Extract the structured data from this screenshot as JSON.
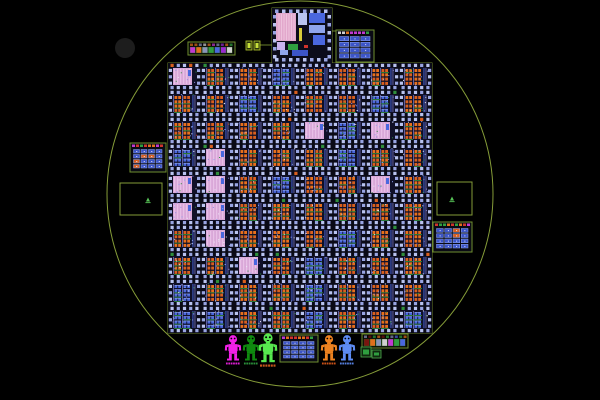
{
  "app": {
    "background": "#000000",
    "seed": 7
  },
  "wafer": {
    "cx": 300,
    "cy": 194,
    "r": 193,
    "outline_color": "#93ad3e"
  },
  "mark_circle": {
    "cx": 125,
    "cy": 48,
    "r": 10,
    "color": "#1d1d1d"
  },
  "outlines": {
    "color": "#7d9636",
    "grid": {
      "x": 168,
      "y": 63,
      "w": 264,
      "h": 270
    },
    "top_die": {
      "x": 272,
      "y": 8,
      "w": 60,
      "h": 55
    },
    "connectors": [
      {
        "x1": 259,
        "y1": 45,
        "x2": 272,
        "y2": 45
      },
      {
        "x1": 332,
        "y1": 31,
        "x2": 336,
        "y2": 31
      }
    ]
  },
  "die_grid": {
    "x": 168,
    "y": 63,
    "cols": 8,
    "rows": 10,
    "cell_w": 33,
    "cell_h": 27,
    "colors": {
      "bg": "#0a0a16",
      "inner": "#101028",
      "pad": "#b9c3ef",
      "pad_dim": "#98a4e2",
      "orange": "#d95f1e",
      "orange2": "#e8701c",
      "blue": "#4a67de",
      "blue_light": "#8fa5ec",
      "violet": "#8d8de0",
      "green_line": "#2f8f3c",
      "pink": "#d9a8d8",
      "pink_light": "#eac4ea",
      "white": "#e8e8f4",
      "red": "#d0342c"
    },
    "variant_pink_prob": 0.08,
    "variant_blue_prob": 0.18
  },
  "top_die": {
    "x": 272,
    "y": 8,
    "w": 60,
    "h": 55,
    "bg": "#0c0c1a",
    "features": [
      {
        "x": 276,
        "y": 13,
        "w": 20,
        "h": 28,
        "fill": "#e2a8cc",
        "striped": true
      },
      {
        "x": 277,
        "y": 42,
        "w": 8,
        "h": 8,
        "fill": "#c9b2ee"
      },
      {
        "x": 298,
        "y": 13,
        "w": 9,
        "h": 12,
        "fill": "#b9c3ef"
      },
      {
        "x": 309,
        "y": 13,
        "w": 16,
        "h": 10,
        "fill": "#4a67de"
      },
      {
        "x": 309,
        "y": 25,
        "w": 16,
        "h": 8,
        "fill": "#8fa5ec"
      },
      {
        "x": 313,
        "y": 35,
        "w": 12,
        "h": 10,
        "fill": "#4a67de"
      },
      {
        "x": 299,
        "y": 28,
        "w": 3,
        "h": 13,
        "fill": "#d8cc3a"
      },
      {
        "x": 288,
        "y": 44,
        "w": 10,
        "h": 6,
        "fill": "#2f9f3f"
      },
      {
        "x": 304,
        "y": 45,
        "w": 4,
        "h": 3,
        "fill": "#d0342c"
      },
      {
        "x": 292,
        "y": 50,
        "w": 16,
        "h": 6,
        "fill": "#3c55c8"
      },
      {
        "x": 280,
        "y": 50,
        "w": 8,
        "h": 5,
        "fill": "#8fa5ec"
      }
    ]
  },
  "mini_dies": [
    {
      "name": "left-edge-die",
      "x": 130,
      "y": 143,
      "w": 36,
      "h": 29,
      "cols": 4,
      "rows": 4,
      "orange_prob": 0.2
    },
    {
      "name": "top-right-die",
      "x": 336,
      "y": 30,
      "w": 38,
      "h": 32,
      "cols": 3,
      "rows": 4,
      "orange_prob": 0.12
    },
    {
      "name": "right-edge-die",
      "x": 433,
      "y": 222,
      "w": 39,
      "h": 30,
      "cols": 4,
      "rows": 4,
      "orange_prob": 0.2
    },
    {
      "name": "bottom-center-die",
      "x": 280,
      "y": 335,
      "w": 38,
      "h": 27,
      "cols": 4,
      "rows": 4,
      "orange_prob": 0.05
    }
  ],
  "mini_die_colors": {
    "border": "#6f8f2f",
    "bg": "#0a0a14",
    "cell": "#3c55c8",
    "cell_edge": "#8fa5ec",
    "dot": "#e8e8f4",
    "orange": "#d95f1e",
    "header": [
      "#2f9f3f",
      "#c03ad0",
      "#d0d0d0",
      "#d0342c",
      "#e0701c"
    ]
  },
  "legend_strips": [
    {
      "name": "top-left-legend",
      "x": 188,
      "y": 42,
      "w": 47,
      "h": 13,
      "cells": [
        "#c03ad0",
        "#e0701c",
        "#8a94b8",
        "#2f9f3f",
        "#4a67de",
        "#9a2ad0",
        "#d0d0d0"
      ]
    },
    {
      "name": "bottom-right-legend",
      "x": 362,
      "y": 334,
      "w": 46,
      "h": 14,
      "cells": [
        "#7a1410",
        "#e0701c",
        "#8a94b8",
        "#d0d0d0",
        "#c03ad0",
        "#2f9f3f",
        "#4a67de"
      ]
    }
  ],
  "green_pads_top": [
    {
      "x": 246,
      "y": 41,
      "w": 6,
      "h": 9
    },
    {
      "x": 254,
      "y": 41,
      "w": 6,
      "h": 9
    }
  ],
  "green_squares_bottom": [
    {
      "x": 361,
      "y": 347,
      "w": 10,
      "h": 10
    },
    {
      "x": 372,
      "y": 350,
      "w": 9,
      "h": 8
    }
  ],
  "green_pad_colors": {
    "fill": "#2a330c",
    "stroke": "#b9cf2e",
    "inner": "#c8e03a"
  },
  "green_square_colors": {
    "fill": "#0f2a0f",
    "stroke": "#4fae4f",
    "inner": "#2f9f3f"
  },
  "alignment_squares": [
    {
      "name": "left-alignment-square",
      "x": 120,
      "y": 183,
      "w": 42,
      "h": 32,
      "gx": 148,
      "gy": 200
    },
    {
      "name": "right-alignment-square",
      "x": 437,
      "y": 182,
      "w": 35,
      "h": 33,
      "gx": 452,
      "gy": 199
    }
  ],
  "alignment_color": "#93ad3e",
  "glyph_color": "#58c558",
  "robots": [
    {
      "name": "magenta",
      "color": "#f320e8",
      "label_color": "#f320e8",
      "x": 233,
      "y": 348,
      "scale": 0.88
    },
    {
      "name": "dark-green",
      "color": "#0f8a0f",
      "label_color": "#2f9f3f",
      "x": 251,
      "y": 348,
      "scale": 0.88
    },
    {
      "name": "lime",
      "color": "#57e84f",
      "label_color": "#d95f1e",
      "x": 268,
      "y": 348,
      "scale": 1.0
    },
    {
      "name": "orange",
      "color": "#ef8320",
      "label_color": "#e05a1a",
      "x": 329,
      "y": 348,
      "scale": 0.88
    },
    {
      "name": "blue",
      "color": "#5e8cf5",
      "label_color": "#5e8cf5",
      "x": 347,
      "y": 348,
      "scale": 0.88
    }
  ]
}
